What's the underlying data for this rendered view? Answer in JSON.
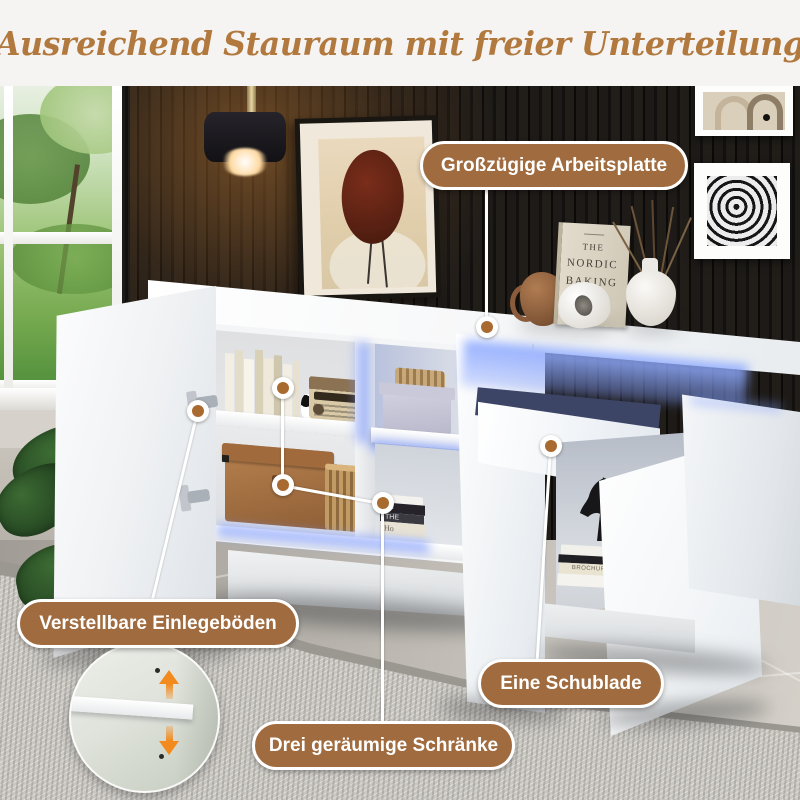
{
  "page": {
    "title_text": "Ausreichend Stauraum mit freier Unterteilung"
  },
  "callouts": {
    "arbeitsplatte": {
      "label": "Großzügige Arbeitsplatte"
    },
    "einlegeboeden": {
      "label": "Verstellbare Einlegeböden"
    },
    "schraenke": {
      "label": "Drei geräumige Schränke"
    },
    "schublade": {
      "label": "Eine Schublade"
    }
  },
  "decor": {
    "baking_book": {
      "line1": "THE",
      "line2": "NORDIC",
      "line3": "BAKING",
      "line4": "BOX"
    },
    "shelf_books": {
      "spine1": "the",
      "spine2": "THE",
      "spine3": "Ho"
    },
    "floor_books": {
      "spine1": "BROCHURE"
    }
  },
  "colors": {
    "title": "#b2793e",
    "pill_background": "#a06b3e",
    "pill_border": "#ffffff",
    "pill_text": "#ffffff",
    "led_glow": "#7e9bff",
    "arrow_orange": "#f28a1e",
    "wall": "#1d1a17",
    "cabinet": "#f4f5f6"
  }
}
